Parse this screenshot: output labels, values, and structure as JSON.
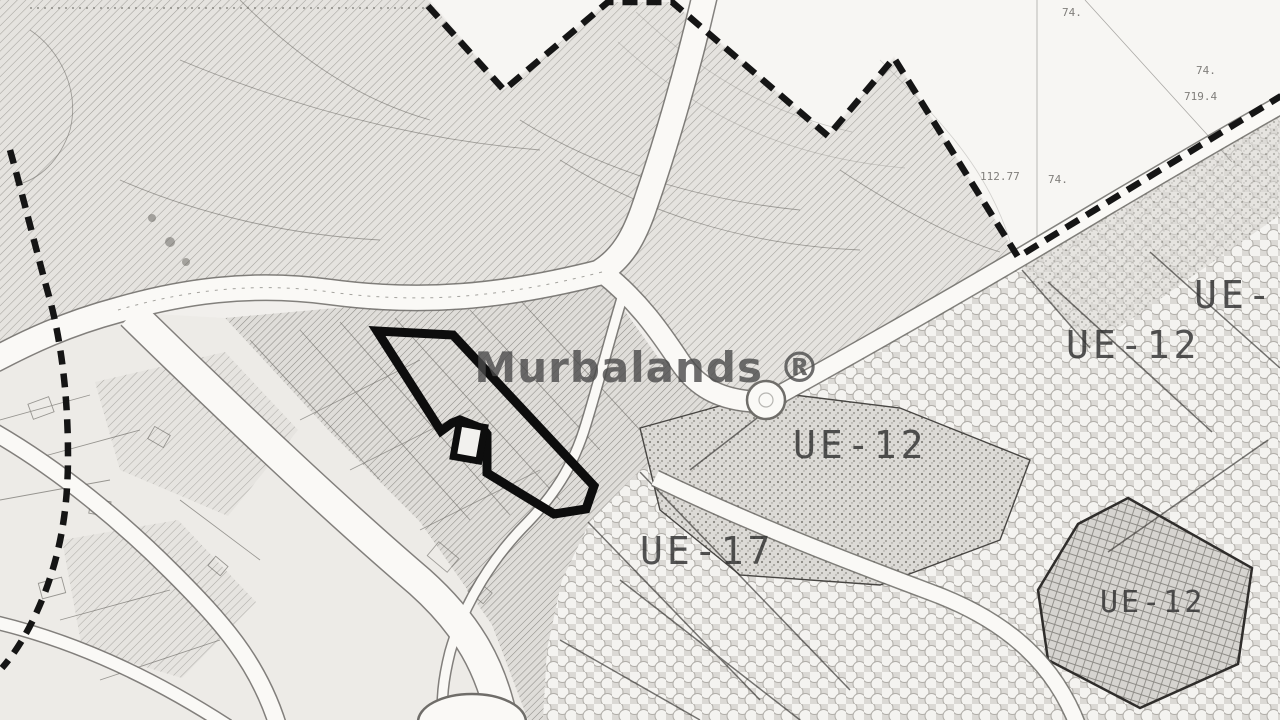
{
  "map": {
    "watermark": {
      "text": "Murbalands ®",
      "color": "#4a4a4a"
    },
    "zone_labels": [
      {
        "id": "ue-top-right-partial",
        "text": "UE-"
      },
      {
        "id": "ue12-upper-right",
        "text": "UE-12"
      },
      {
        "id": "ue12-center-right",
        "text": "UE-12"
      },
      {
        "id": "ue17-center",
        "text": "UE-17"
      },
      {
        "id": "ue12-bottom-right",
        "text": "UE-12"
      }
    ],
    "survey_annotations": [
      {
        "text": "74."
      },
      {
        "text": "719.4"
      },
      {
        "text": "112.77"
      },
      {
        "text": "74."
      },
      {
        "text": "74."
      }
    ],
    "colors": {
      "paper": "#f1efec",
      "zone_hatch": "#e3e1dd",
      "boundary_line": "#151515",
      "parcel_highlight": "#0d0d0d",
      "label_text": "#2f2f2f",
      "road_fill": "#faf9f6"
    }
  }
}
